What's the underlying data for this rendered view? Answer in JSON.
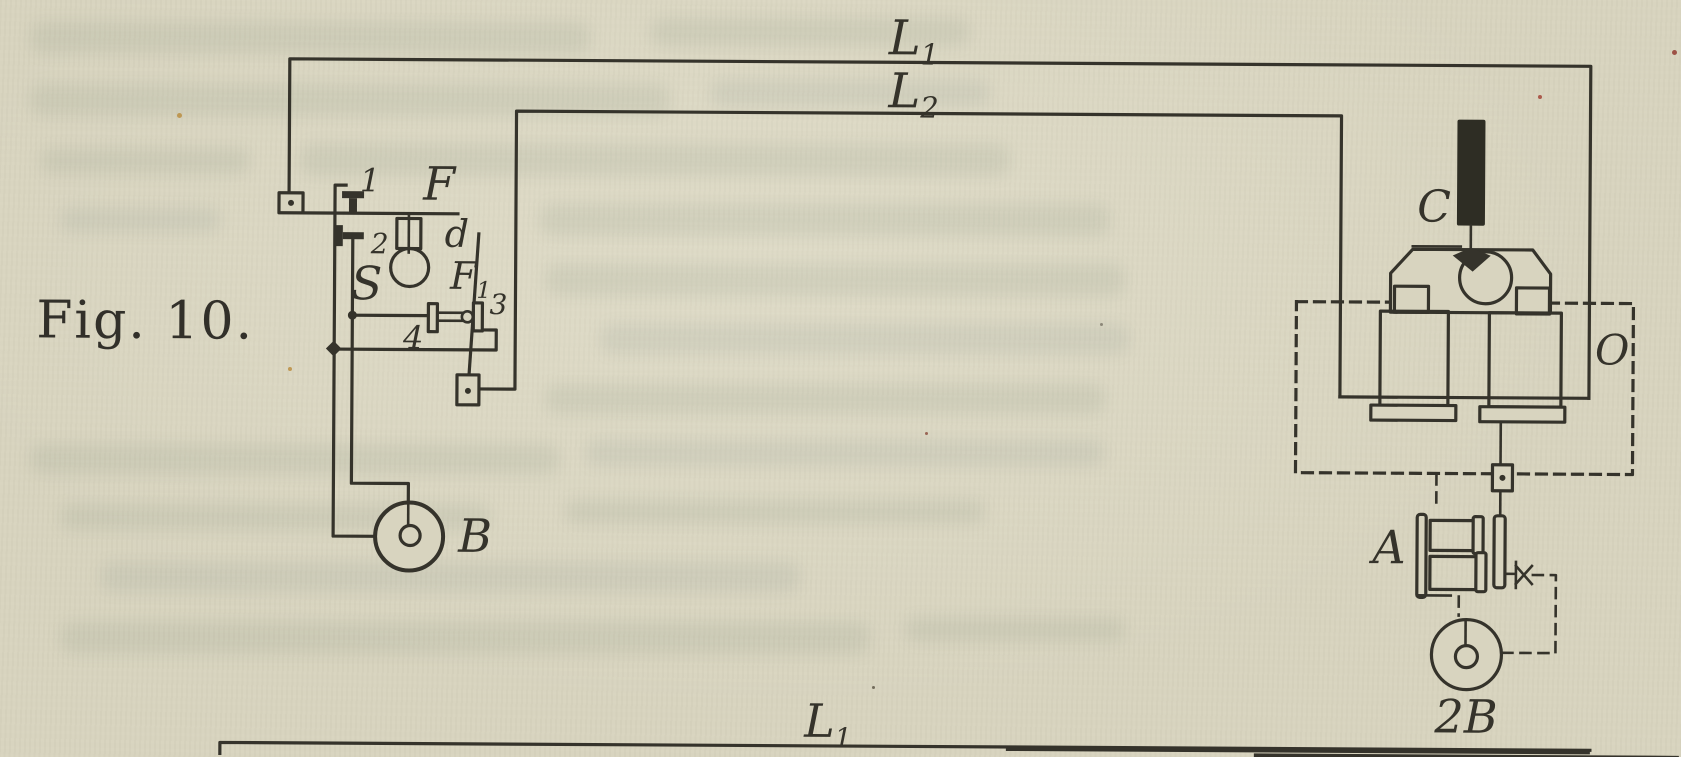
{
  "figure": {
    "caption": "Fig. 10.",
    "colors": {
      "paper": "#d8d4bf",
      "ink": "#35332b"
    },
    "line_labels": {
      "top": {
        "base": "L",
        "sub": "1"
      },
      "middle": {
        "base": "L",
        "sub": "2"
      },
      "bottom": {
        "base": "L",
        "sub": "1"
      }
    },
    "left_station": {
      "frame_label": "F",
      "lever_label": {
        "base": "F",
        "sub": "1"
      },
      "pendulum_label": "d",
      "spring_label": "S",
      "contact1": "1",
      "contact2": "2",
      "contact3": "3",
      "contact4": "4",
      "battery_label": "B"
    },
    "right_station": {
      "pen_label": "C",
      "local_circuit_label": "O",
      "electromagnet_label": "A",
      "battery_label": "2B"
    }
  }
}
